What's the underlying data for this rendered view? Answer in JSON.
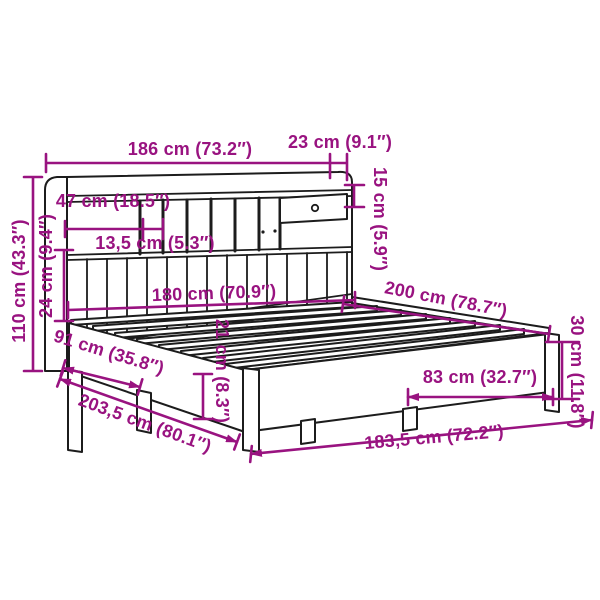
{
  "diagram": {
    "subject": "bookcase-bed-with-headboard-line-drawing",
    "style": "technical dimension diagram, 3/4 perspective",
    "accent_color": "#991380",
    "line_color": "#1c1c1c",
    "background_color": "#ffffff"
  },
  "dimensions": {
    "headboard_width": {
      "cm": 186,
      "inches": 73.2,
      "label": "186 cm (73.2″)"
    },
    "shelf_depth": {
      "cm": 23,
      "inches": 9.1,
      "label": "23 cm (9.1″)"
    },
    "top_shelf_height": {
      "cm": 15,
      "inches": 5.9,
      "label": "15 cm (5.9″)"
    },
    "compartment_width": {
      "cm": 47,
      "inches": 18.5,
      "label": "47 cm (18.5″)"
    },
    "slot_width": {
      "cm": 13.5,
      "inches": 5.3,
      "label": "13,5 cm (5.3″)"
    },
    "headboard_height": {
      "cm": 110,
      "inches": 43.3,
      "label": "110 cm (43.3″)"
    },
    "plank_panel_height": {
      "cm": 24,
      "inches": 9.4,
      "label": "24 cm (9.4″)"
    },
    "inner_width": {
      "cm": 180,
      "inches": 70.9,
      "label": "180 cm (70.9″)"
    },
    "bed_length": {
      "cm": 200,
      "inches": 78.7,
      "label": "200 cm (78.7″)"
    },
    "frame_height": {
      "cm": 30,
      "inches": 11.8,
      "label": "30 cm (11.8″)"
    },
    "rail_height": {
      "cm": 21,
      "inches": 8.3,
      "label": "21 cm (8.3″)"
    },
    "headboard_to_leg": {
      "cm": 91,
      "inches": 35.8,
      "label": "91 cm (35.8″)"
    },
    "total_side_length": {
      "cm": 203.5,
      "inches": 80.1,
      "label": "203,5 cm (80.1″)"
    },
    "leg_spacing": {
      "cm": 83,
      "inches": 32.7,
      "label": "83 cm (32.7″)"
    },
    "frame_width": {
      "cm": 183.5,
      "inches": 72.2,
      "label": "183,5 cm (72.2″)"
    }
  }
}
